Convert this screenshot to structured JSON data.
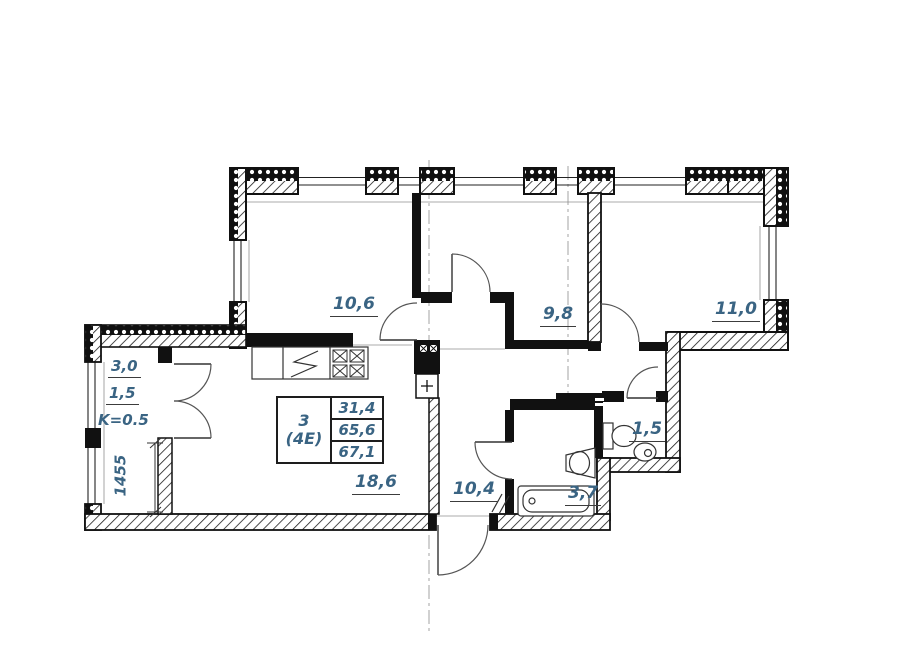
{
  "stamp": {
    "room_count": "3",
    "type": "(4Е)",
    "living_area": "31,4",
    "total_area": "65,6",
    "total_with_balcony": "67,1"
  },
  "rooms": {
    "bedroom1": "10,6",
    "bedroom2": "9,8",
    "bedroom3": "11,0",
    "kitchen_living": "18,6",
    "hall": "10,4",
    "bathroom": "3,7",
    "wc": "1,5"
  },
  "balcony": {
    "area": "3,0",
    "reduced": "1,5",
    "coefficient": "K=0.5",
    "width_mm": "1455"
  }
}
